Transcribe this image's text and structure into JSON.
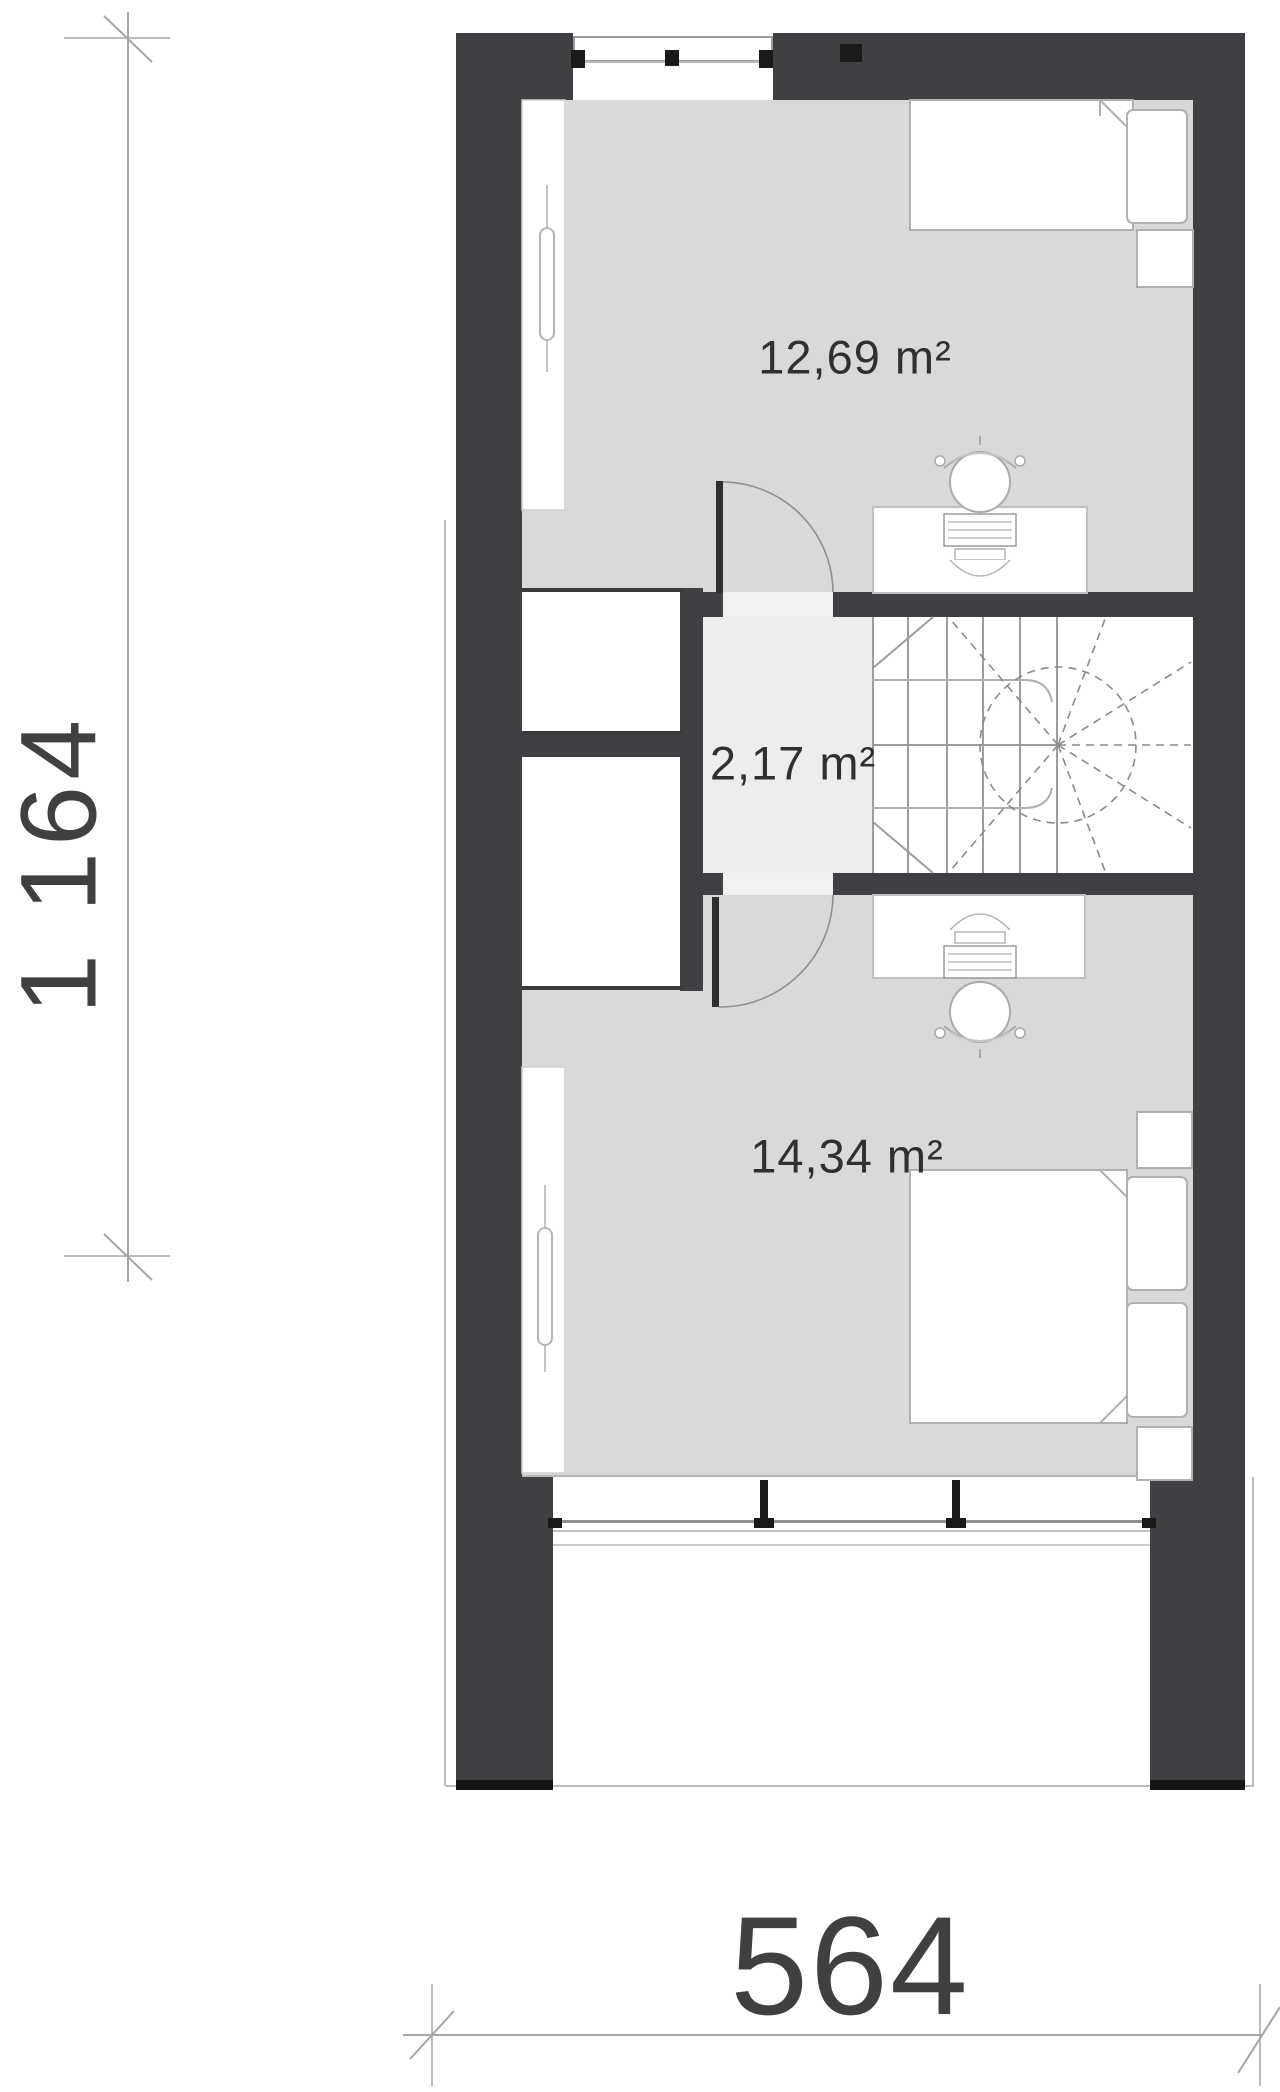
{
  "plan": {
    "rooms": [
      {
        "id": "bedroom-upper",
        "area_label": "12,69 m²"
      },
      {
        "id": "hallway",
        "area_label": "2,17 m²"
      },
      {
        "id": "bedroom-lower",
        "area_label": "14,34 m²"
      }
    ],
    "dimensions": {
      "vertical_label": "1 164",
      "horizontal_label": "564"
    },
    "colors": {
      "wall": "#3e4043",
      "floor_room": "#d9d9d9",
      "floor_hall": "#ededed",
      "thin_line": "#9c9c9c",
      "background": "#ffffff"
    }
  }
}
